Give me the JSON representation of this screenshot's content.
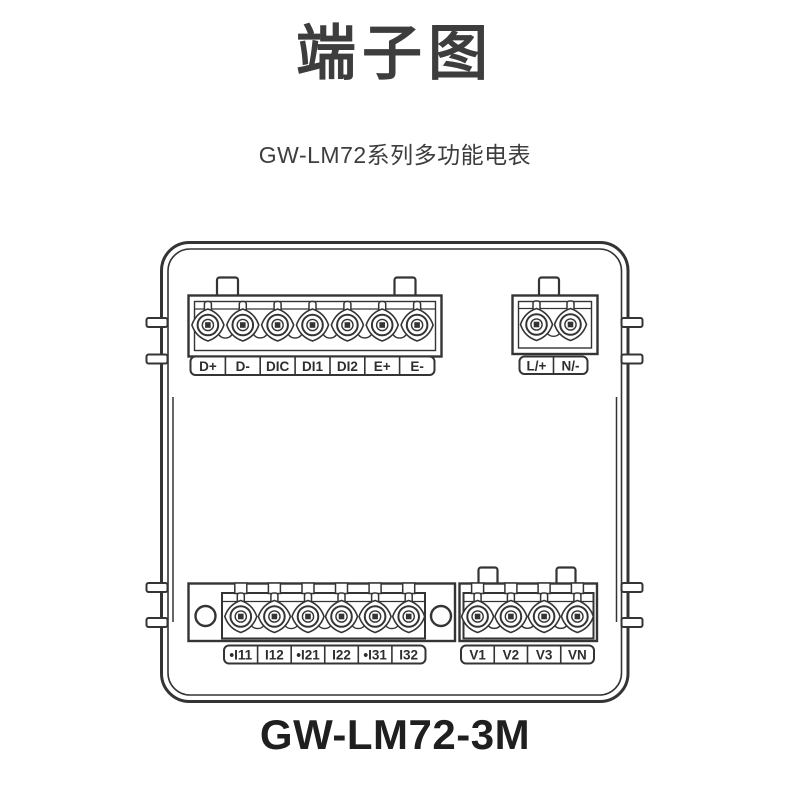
{
  "page": {
    "title": "端子图",
    "subtitle": "GW-LM72系列多功能电表",
    "model_caption": "GW-LM72-3M"
  },
  "colors": {
    "background": "#ffffff",
    "line_art": "#343434",
    "title_text": "#3d3d3d",
    "subtitle_text": "#3d3d3d",
    "caption_text": "#1f1f1f",
    "label_text": "#2e2e2e"
  },
  "blocks": {
    "top_left": {
      "labels": [
        "D+",
        "D-",
        "DIC",
        "DI1",
        "DI2",
        "E+",
        "E-"
      ]
    },
    "top_right": {
      "labels": [
        "L/+",
        "N/-"
      ]
    },
    "bottom_left": {
      "labels": [
        "•I11",
        "I12",
        "•I21",
        "I22",
        "•I31",
        "I32"
      ]
    },
    "bottom_right": {
      "labels": [
        "V1",
        "V2",
        "V3",
        "VN"
      ]
    }
  }
}
